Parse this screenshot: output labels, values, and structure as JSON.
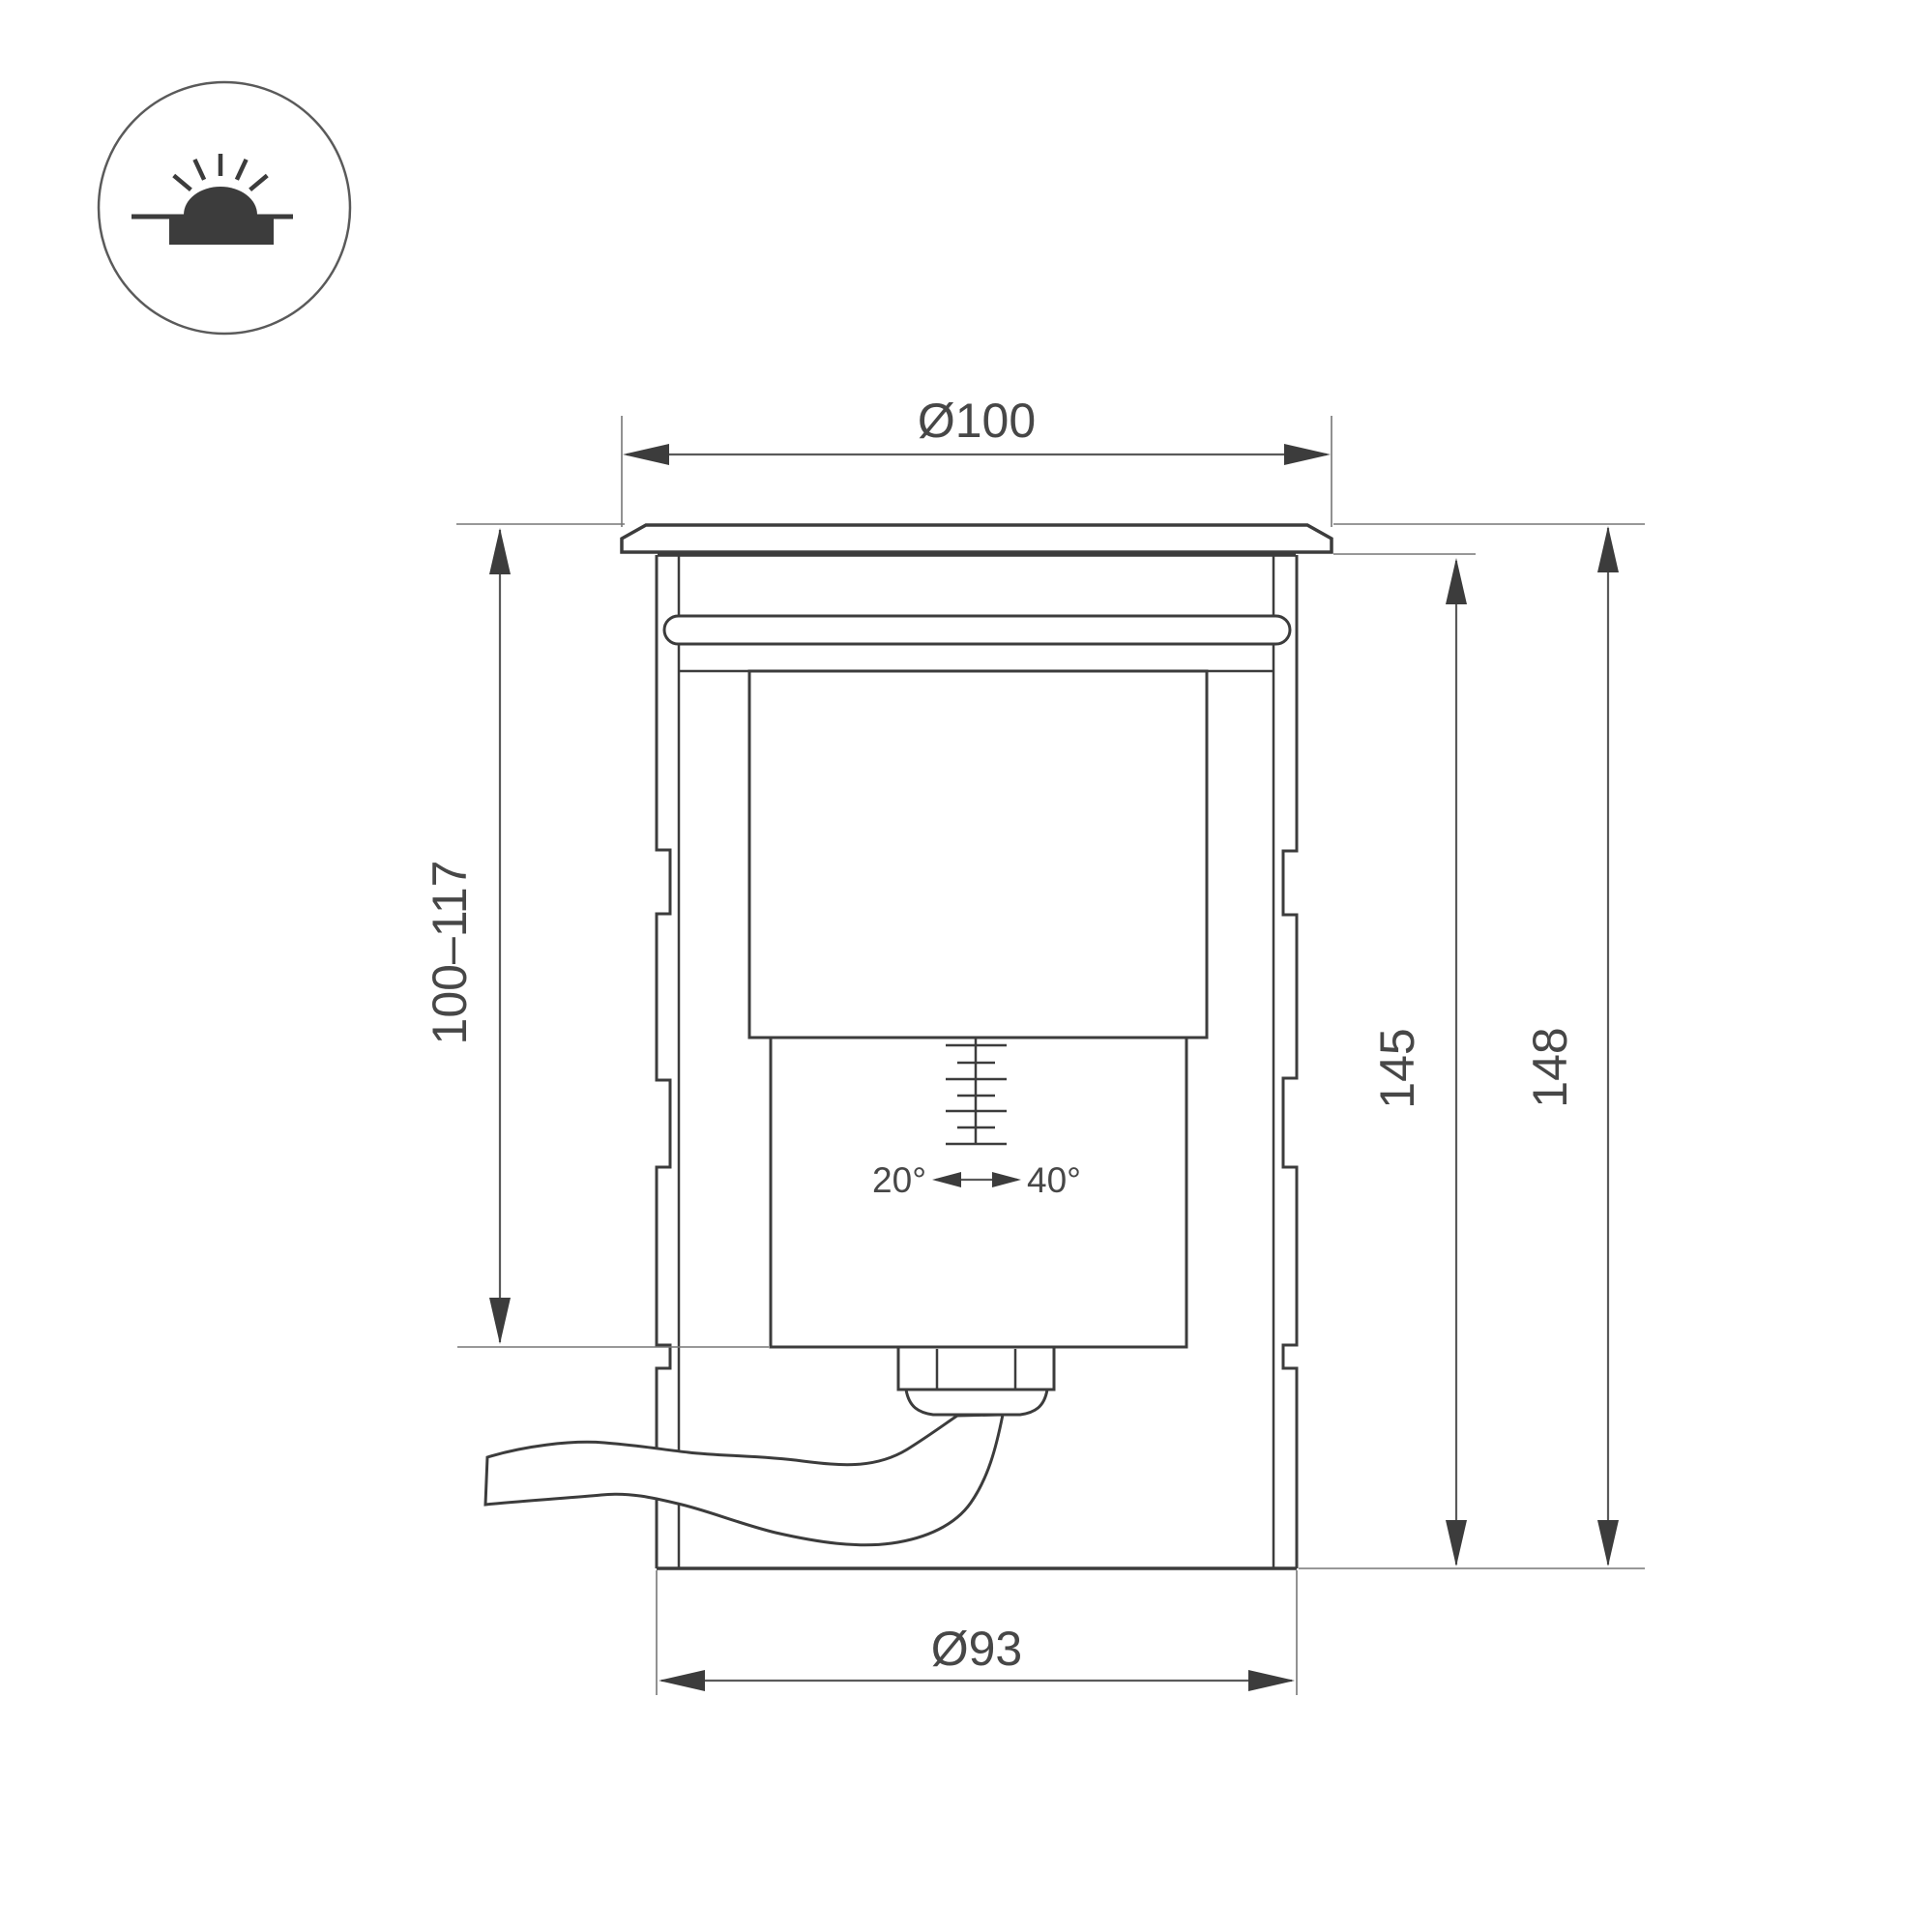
{
  "icon": {
    "name": "recessed-ground-luminaire-symbol"
  },
  "dimensions": {
    "top_diameter": "Ø100",
    "bottom_diameter": "Ø93",
    "recess_depth": "100–117",
    "body_height": "145",
    "overall_height": "148",
    "tilt_min": "20°",
    "tilt_max": "40°"
  },
  "colors": {
    "main_line": "#3c3c3c",
    "dimension_line": "#5a5a5a",
    "extension_line": "#767676",
    "text": "#474747",
    "background": "#ffffff"
  }
}
